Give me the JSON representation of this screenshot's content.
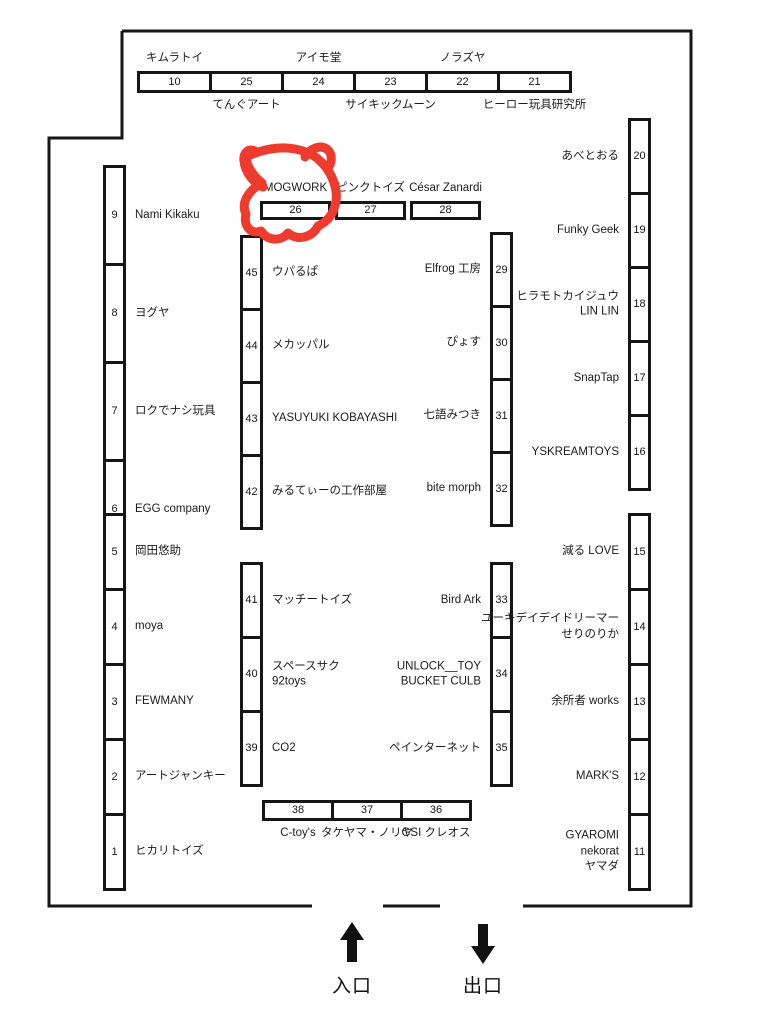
{
  "venue": {
    "entrance_label": "入口",
    "exit_label": "出口"
  },
  "annotation": {
    "description": "hand-drawn red marker doodle with horns circling booth 26",
    "color": "#ee3b2e",
    "marked_booth": "26"
  },
  "groups": [
    {
      "id": "top-row",
      "booths": [
        {
          "num": "10",
          "label": "キムラトイ",
          "label_pos": "above"
        },
        {
          "num": "25",
          "label": "てんぐアート",
          "label_pos": "below"
        },
        {
          "num": "24",
          "label": "アイモ堂",
          "label_pos": "above"
        },
        {
          "num": "23",
          "label": "サイキックムーン",
          "label_pos": "below"
        },
        {
          "num": "22",
          "label": "ノラズヤ",
          "label_pos": "above"
        },
        {
          "num": "21",
          "label": "ヒーロー玩具研究所",
          "label_pos": "below"
        }
      ]
    },
    {
      "id": "row-26",
      "booths": [
        {
          "num": "26",
          "label": "MOGWORK",
          "label_pos": "above"
        },
        {
          "num": "27",
          "label": "ピンクトイズ",
          "label_pos": "above"
        },
        {
          "num": "28",
          "label": "César Zanardi",
          "label_pos": "above"
        }
      ]
    },
    {
      "id": "left-top",
      "booths": [
        {
          "num": "9",
          "label": "Nami Kikaku",
          "label_pos": "right"
        },
        {
          "num": "8",
          "label": "ヨグヤ",
          "label_pos": "right"
        },
        {
          "num": "7",
          "label": "ロクでナシ玩具",
          "label_pos": "right"
        },
        {
          "num": "6",
          "label": "EGG company",
          "label_pos": "right"
        }
      ]
    },
    {
      "id": "left-bottom",
      "booths": [
        {
          "num": "5",
          "label": "岡田悠助",
          "label_pos": "right"
        },
        {
          "num": "4",
          "label": "moya",
          "label_pos": "right"
        },
        {
          "num": "3",
          "label": "FEWMANY",
          "label_pos": "right"
        },
        {
          "num": "2",
          "label": "アートジャンキー",
          "label_pos": "right"
        },
        {
          "num": "1",
          "label": "ヒカリトイズ",
          "label_pos": "right"
        }
      ]
    },
    {
      "id": "mid-left-top",
      "booths": [
        {
          "num": "45",
          "label": "ウパるぱ",
          "label_pos": "right"
        },
        {
          "num": "44",
          "label": "メカッパル",
          "label_pos": "right"
        },
        {
          "num": "43",
          "label": "YASUYUKI KOBAYASHI",
          "label_pos": "right"
        },
        {
          "num": "42",
          "label": "みるてぃーの工作部屋",
          "label_pos": "right"
        }
      ]
    },
    {
      "id": "mid-left-bottom",
      "booths": [
        {
          "num": "41",
          "label": "マッチートイズ",
          "label_pos": "right"
        },
        {
          "num": "40",
          "label": "スペースサク\n92toys",
          "label_pos": "right"
        },
        {
          "num": "39",
          "label": "CO2",
          "label_pos": "right"
        }
      ]
    },
    {
      "id": "mid-right-top",
      "booths": [
        {
          "num": "29",
          "label": "Elfrog 工房",
          "label_pos": "left"
        },
        {
          "num": "30",
          "label": "ぴょす",
          "label_pos": "left"
        },
        {
          "num": "31",
          "label": "七語みつき",
          "label_pos": "left"
        },
        {
          "num": "32",
          "label": "bite morph",
          "label_pos": "left"
        }
      ]
    },
    {
      "id": "mid-right-bottom",
      "booths": [
        {
          "num": "33",
          "label": "Bird Ark",
          "label_pos": "left"
        },
        {
          "num": "34",
          "label": "UNLOCK__TOY\nBUCKET CULB",
          "label_pos": "left"
        },
        {
          "num": "35",
          "label": "ペインターネット",
          "label_pos": "left"
        }
      ]
    },
    {
      "id": "right-top",
      "booths": [
        {
          "num": "20",
          "label": "あべとおる",
          "label_pos": "left"
        },
        {
          "num": "19",
          "label": "Funky Geek",
          "label_pos": "left"
        },
        {
          "num": "18",
          "label": "ヒラモトカイジュウ\nLIN LIN",
          "label_pos": "left"
        },
        {
          "num": "17",
          "label": "SnapTap",
          "label_pos": "left"
        },
        {
          "num": "16",
          "label": "YSKREAMTOYS",
          "label_pos": "left"
        }
      ]
    },
    {
      "id": "right-bottom",
      "booths": [
        {
          "num": "15",
          "label": "減る LOVE",
          "label_pos": "left"
        },
        {
          "num": "14",
          "label": "ユーキデイデイドリーマー\nせりのりか",
          "label_pos": "left"
        },
        {
          "num": "13",
          "label": "余所者 works",
          "label_pos": "left"
        },
        {
          "num": "12",
          "label": "MARK'S",
          "label_pos": "left"
        },
        {
          "num": "11",
          "label": "GYAROMI\nnekorat\nヤマダ",
          "label_pos": "left"
        }
      ]
    },
    {
      "id": "bottom-row",
      "booths": [
        {
          "num": "38",
          "label": "C-toy's",
          "label_pos": "below"
        },
        {
          "num": "37",
          "label": "タケヤマ・ノリヤ",
          "label_pos": "below"
        },
        {
          "num": "36",
          "label": "GSI クレオス",
          "label_pos": "below"
        }
      ]
    }
  ]
}
